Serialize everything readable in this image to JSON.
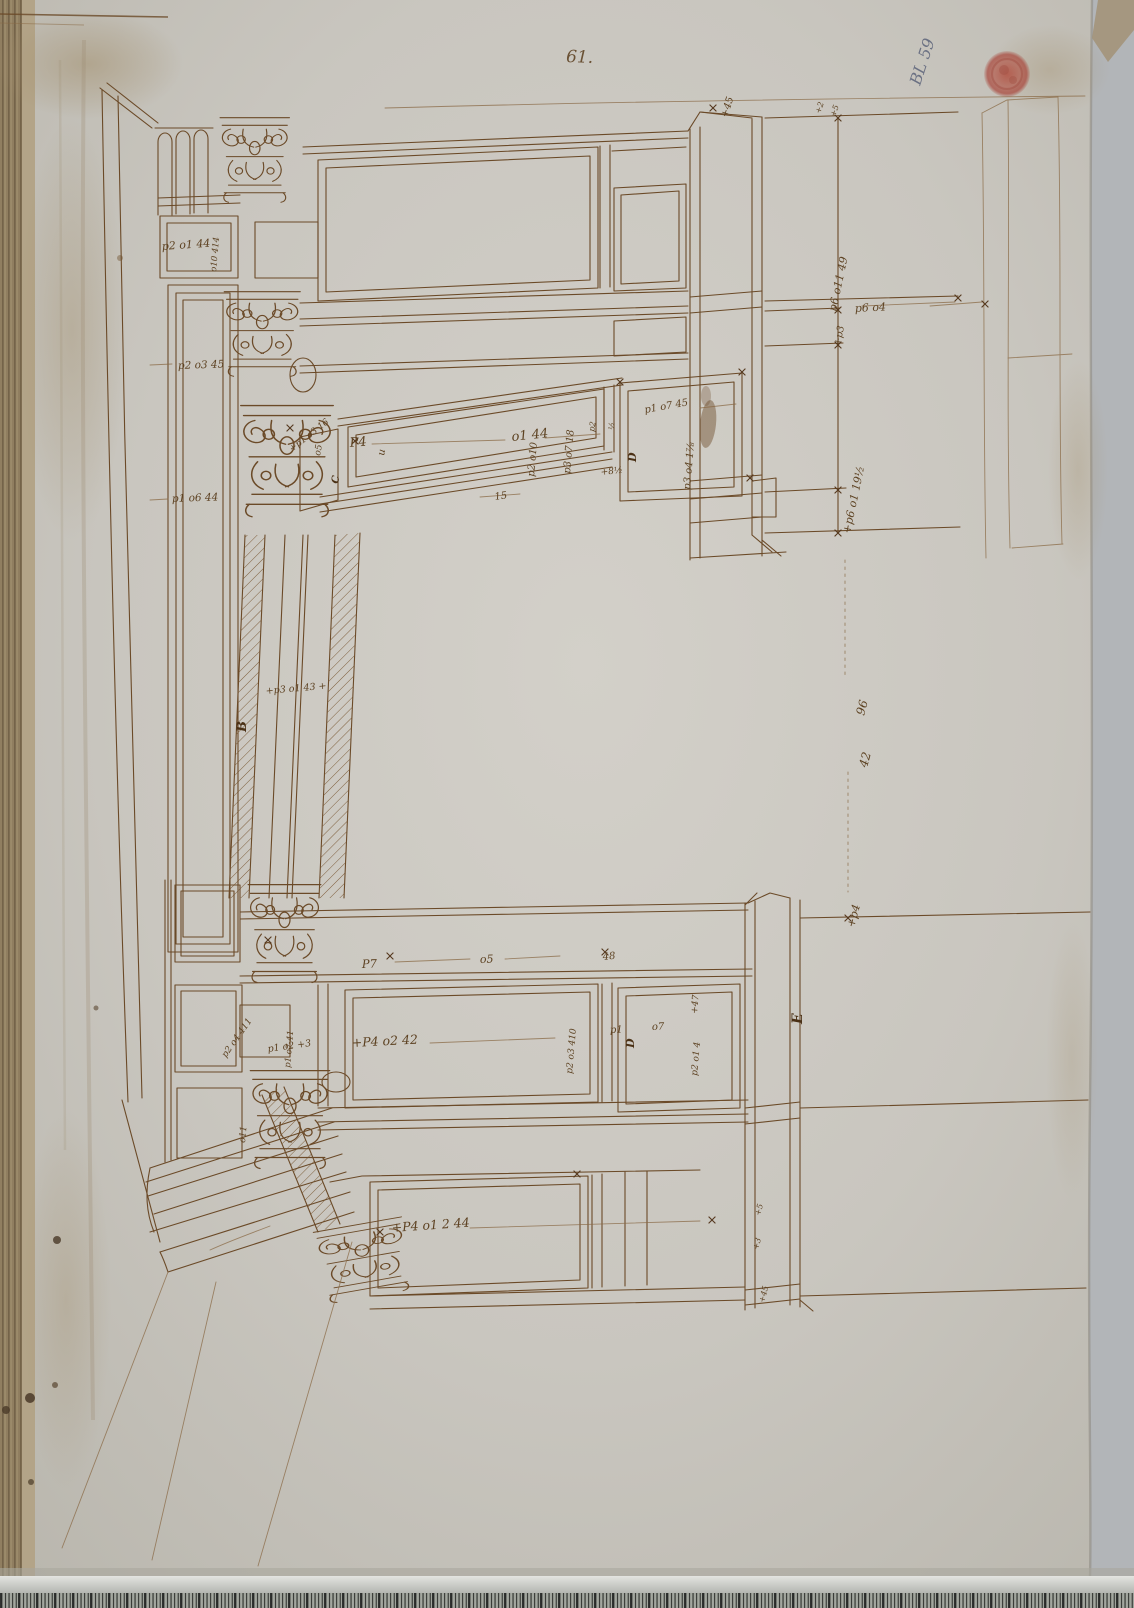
{
  "page": {
    "folio_number": "61.",
    "catalog_number": "BL 59"
  },
  "colors": {
    "ink": "#6b4a28",
    "ink_dark": "#55381e",
    "paper": "#c9c6bf",
    "stamp_red": "#ad4a38",
    "pencil_blue": "#6b7183"
  },
  "letters": {
    "b": "B",
    "c": "C",
    "u": "u",
    "d_upper": "D",
    "d_lower": "D",
    "e": "E"
  },
  "annotations": {
    "a0": "+45",
    "a1": "+2",
    "a2": "+5",
    "a3": "p2 o1 44",
    "a4": "o10 414",
    "a5": "p2 o3 45",
    "a6": "p1 o6 44",
    "a7": "+p1 o3 16",
    "a8": "o5",
    "a9": "P4",
    "a10": "o1 44",
    "a11": "p2 o10",
    "a12": "p3 o7 18",
    "a13": "15",
    "a14": "p1 o7 45",
    "a15": "p3 o4 1⅞",
    "a16": "+8½",
    "a17": "p2",
    "a18": "½",
    "a19": "p6 o11 49",
    "a20": "p6 o4",
    "a21": "+p3",
    "a22": "+p6 o1 19½",
    "a23": "96",
    "a24": "42",
    "a25": "+p4",
    "a26": "P7",
    "a27": "o5",
    "a28": "48",
    "a29": "p1 o7 41",
    "a30": "p1 o2 +3",
    "a31": "+P4 o2 42",
    "a32": "p2 o3 410",
    "a33": "p2 o4 411",
    "a34": "o11",
    "a35": "+47",
    "a36": "p1",
    "a37": "o7",
    "a38": "p2 o1 4",
    "a39": "+P4 o1 2 44",
    "a40": "+5",
    "a41": "+3",
    "a42": "+p3 o1 43 +",
    "a43": "+45"
  }
}
